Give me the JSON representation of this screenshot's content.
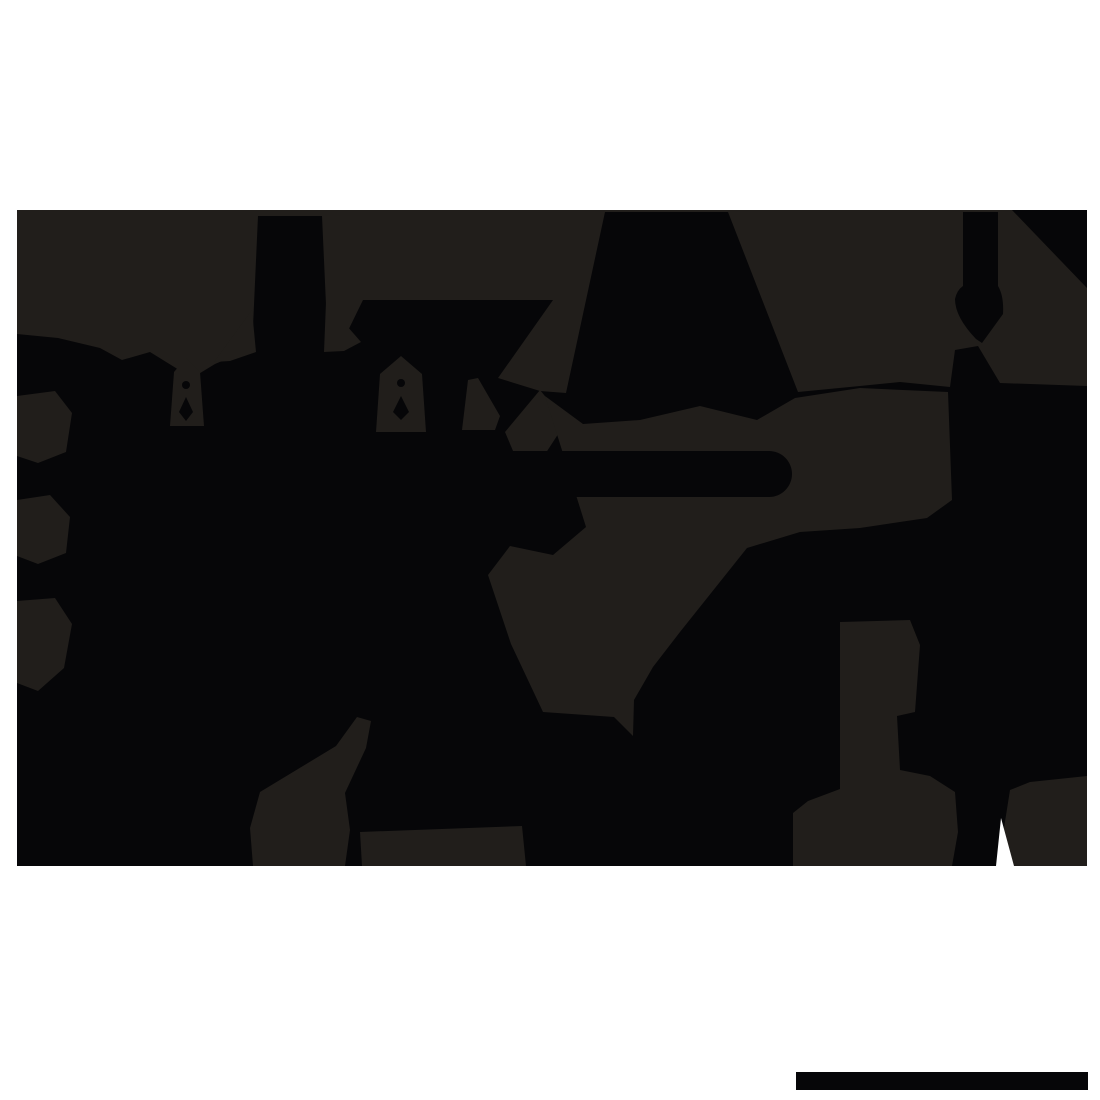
{
  "image": {
    "kind": "silhouette-illustration",
    "description": "Abstract flattened black silhouette artwork with towers, peaks, hanging finials, a diamond-knotted blade and lighter charcoal patches, over a white canvas; solid black watermark bar at bottom right."
  },
  "canvas": {
    "width": 1100,
    "height": 1100,
    "background": "#ffffff"
  },
  "palette": {
    "ink_black": "#060608",
    "ink_soft": "#211e1b",
    "white": "#ffffff"
  },
  "watermark_bar": {
    "x": 796,
    "y": 1072,
    "width": 292,
    "height": 18,
    "fill": "#060608"
  },
  "shapes": [
    {
      "name": "silhouette-backdrop",
      "kind": "rect",
      "x": 17,
      "y": 210,
      "width": 1070,
      "height": 656,
      "fill": "#211e1b"
    },
    {
      "name": "main-black-mass",
      "kind": "polygon",
      "fill": "#060608",
      "points": "17,334 58,338 100,348 122,360 150,352 192,378 215,364 234,356 252,349 258,216 322,216 328,349 342,343 363,300 553,300 498,378 540,391 566,393 605,212 728,212 798,392 860,386 900,382 950,387 955,350 978,346 1000,383 1087,386 1087,866 17,866"
    },
    {
      "name": "right-column-diamond-knot",
      "kind": "path",
      "fill": "#060608",
      "d": "M963,212 L998,212 L998,286 Q1004,296 1003,314 L982,343 L976,339 Q955,317 955,299 Q957,290 963,286 Z"
    },
    {
      "name": "top-right-corner-wedge",
      "kind": "polygon",
      "fill": "#060608",
      "points": "1012,210 1087,210 1087,288"
    },
    {
      "name": "left-edge-patch-upper",
      "kind": "polygon",
      "fill": "#211e1b",
      "points": "17,396 55,391 72,413 66,452 38,463 17,456"
    },
    {
      "name": "left-edge-patch-middle",
      "kind": "polygon",
      "fill": "#211e1b",
      "points": "17,500 50,495 70,517 66,553 38,564 17,556"
    },
    {
      "name": "left-edge-patch-lower",
      "kind": "polygon",
      "fill": "#211e1b",
      "points": "17,601 55,598 72,624 64,668 38,691 17,683"
    },
    {
      "name": "valley-left-of-tower",
      "kind": "polygon",
      "fill": "#211e1b",
      "points": "214,362 252,310 256,352 230,361"
    },
    {
      "name": "valley-right-of-tower",
      "kind": "polygon",
      "fill": "#211e1b",
      "points": "324,352 326,302 361,342 344,351"
    },
    {
      "name": "finial-pocket-left",
      "kind": "polygon",
      "fill": "#211e1b",
      "points": "170,426 174,372 186,358 200,372 204,426"
    },
    {
      "name": "finial-left-ball",
      "kind": "circle",
      "cx": 186,
      "cy": 385,
      "r": 4,
      "fill": "#060608"
    },
    {
      "name": "finial-left-drop",
      "kind": "polygon",
      "fill": "#060608",
      "points": "179,412 186,397 193,412 186,421"
    },
    {
      "name": "finial-pocket-center",
      "kind": "polygon",
      "fill": "#211e1b",
      "points": "376,432 380,374 401,356 422,374 426,432"
    },
    {
      "name": "finial-center-ball",
      "kind": "circle",
      "cx": 401,
      "cy": 383,
      "r": 4,
      "fill": "#060608"
    },
    {
      "name": "finial-center-drop",
      "kind": "polygon",
      "fill": "#060608",
      "points": "393,412 401,396 409,412 401,420"
    },
    {
      "name": "pocket-right-of-apex",
      "kind": "polygon",
      "fill": "#211e1b",
      "points": "462,430 468,380 478,378 500,416 495,430"
    },
    {
      "name": "diamond-notch",
      "kind": "polygon",
      "fill": "#211e1b",
      "points": "505,432 540,390 566,422 540,462 516,458"
    },
    {
      "name": "canyon-and-swath-channel",
      "kind": "polygon",
      "fill": "#211e1b",
      "points": "545,396 583,424 640,420 700,406 757,420 795,398 860,388 948,392 952,500 927,518 860,528 800,532 747,548 680,632 653,667 634,700 633,736 614,717 543,712 511,644 488,575 510,546 553,555 586,527"
    },
    {
      "name": "capsule-bar",
      "kind": "path",
      "fill": "#060608",
      "d": "M500,451 L769,451 A23,23 0 0 1 769,497 L500,497 Z"
    },
    {
      "name": "bottom-left-y-patch",
      "kind": "polygon",
      "fill": "#211e1b",
      "points": "250,828 260,792 336,746 357,717 371,721 366,748 345,793 350,830 345,866 253,866"
    },
    {
      "name": "bottom-band-patch",
      "kind": "polygon",
      "fill": "#211e1b",
      "points": "360,832 522,826 526,866 362,866"
    },
    {
      "name": "bottom-column-patch",
      "kind": "polygon",
      "fill": "#211e1b",
      "points": "840,622 910,620 920,645 915,712 897,716 900,770 930,776 955,792 958,832 952,866 793,866 793,813 808,801 840,789"
    },
    {
      "name": "bottom-right-corner-patch",
      "kind": "polygon",
      "fill": "#211e1b",
      "points": "1004,866 1004,828 1010,790 1030,782 1087,776 1087,866"
    },
    {
      "name": "blade-teardrop-highlight",
      "kind": "polygon",
      "fill": "#060608",
      "points": "985,802 1002,823 1000,850 980,866 966,850 963,823"
    },
    {
      "name": "white-v-notch",
      "kind": "polygon",
      "fill": "#ffffff",
      "points": "996,866 1001,818 1014,866"
    }
  ]
}
